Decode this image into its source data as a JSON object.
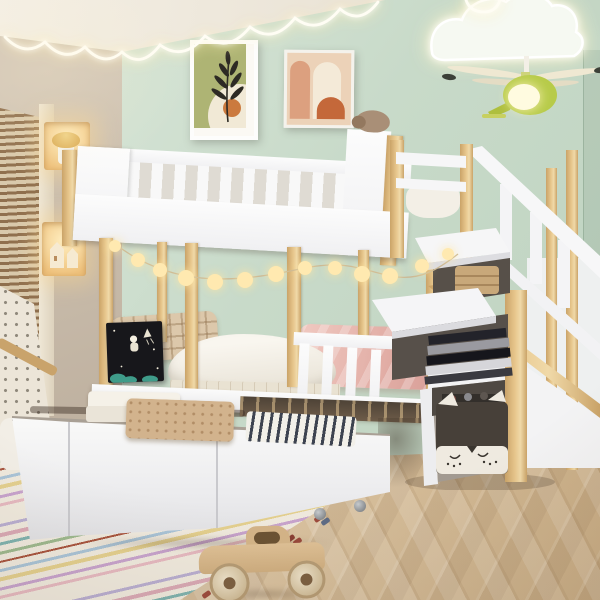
{
  "image_type": "product-lifestyle-photograph",
  "scene_summary": "Children's bedroom with a white and pine twin-over-twin bunk bed featuring a storage staircase with open flap compartments, three pulled-out under-bed storage drawers with folded blankets, mint-green accent wall, fairy lights, and herringbone wood floor",
  "palette": {
    "mint_wall": "#c8dac9",
    "mint_wall_light": "#dbe8db",
    "beige_wall": "#d3c7b8",
    "beige_wall_dark": "#bcae9d",
    "ceiling": "#f4efe5",
    "wood": "#e7c68c",
    "wood_dark": "#caa368",
    "white_panel": "#f0f0f2",
    "slat_gap": "#dfdbd3",
    "floor_light": "#e3cfae",
    "floor_dark": "#c9ad85",
    "rug_base": "#efe9dd",
    "glow_warm": "#ffe9b0",
    "string_light": "#fffdf4",
    "helicopter_green": "#b7cb49",
    "blackboard": "#17171b",
    "chalk": "#ece6d5",
    "chalk_teal": "#3f9c8a",
    "pillow_plaid": "#dcc8ab",
    "duvet_white": "#f9f6ef",
    "blanket_pink": "#e2aea6",
    "quilt_tan": "#d2b38d",
    "stripe_navy": "#3d4350",
    "fox_bin": "#474039",
    "basket_wicker": "#c8a87a",
    "car_wood": "#cfae80",
    "plush_brown": "#a98f77"
  },
  "room": {
    "accent_wall": "mint green",
    "side_wall": "warm beige with two lit display niches",
    "floor": "light oak herringbone parquet",
    "window": "wooden venetian blinds, left edge"
  },
  "objects": [
    {
      "name": "bunk-bed",
      "desc": "white frame with natural pine posts, twin over twin"
    },
    {
      "name": "top-bunk-railing",
      "desc": "white vertical slat guard rail"
    },
    {
      "name": "storage-staircase",
      "desc": "right side, angled flap doors hiding shelves"
    },
    {
      "name": "stair-shelf-basket",
      "desc": "wicker basket in upper stair compartment"
    },
    {
      "name": "stair-shelf-books",
      "desc": "stack of books in middle stair compartment"
    },
    {
      "name": "fox-storage-bin",
      "desc": "dark gray fabric bin with white fox face in bottom cubby"
    },
    {
      "name": "under-bed-drawers",
      "desc": "three white drawers pulled out, casters on right drawer"
    },
    {
      "name": "folded-white-blanket",
      "desc": "cream folded blanket on left drawer"
    },
    {
      "name": "floral-quilt",
      "desc": "tan speckled quilt on middle drawer"
    },
    {
      "name": "striped-blanket",
      "desc": "white and navy striped blanket on right drawer"
    },
    {
      "name": "lower-bunk-bedding",
      "desc": "plaid pillow, white duvet, pink blanket"
    },
    {
      "name": "chalkboard",
      "desc": "black board with chalk astronaut on crescent moon, rocket, teal bushes"
    },
    {
      "name": "plush-bear",
      "desc": "brown plush on top bunk headboard"
    },
    {
      "name": "fairy-light-garland",
      "desc": "warm globe string draped across bed posts"
    },
    {
      "name": "scallop-string-light",
      "desc": "white neon scallop line along ceiling edge"
    },
    {
      "name": "cloud-night-light",
      "desc": "glowing cloud outline on upper right wall"
    },
    {
      "name": "helicopter-lamp",
      "desc": "green helicopter pendant lamp with lit cabin"
    },
    {
      "name": "framed-art-leaf",
      "desc": "dark botanical leaf, olive and cream, orange sun dot"
    },
    {
      "name": "framed-art-arches",
      "desc": "peach and cream abstract arches with orange half circle"
    },
    {
      "name": "wall-niche-mushroom",
      "desc": "lit niche with mushroom house lamp"
    },
    {
      "name": "wall-niche-houses",
      "desc": "lit niche with miniature wooden houses"
    },
    {
      "name": "window-blinds",
      "desc": "wooden slat blinds"
    },
    {
      "name": "striped-rug",
      "desc": "pastel multicolor striped rug with tassels"
    },
    {
      "name": "wooden-toy-car",
      "desc": "natural wood vintage roadster toy"
    },
    {
      "name": "teepee-tent",
      "desc": "speckled fabric play tent edge, far left"
    }
  ]
}
